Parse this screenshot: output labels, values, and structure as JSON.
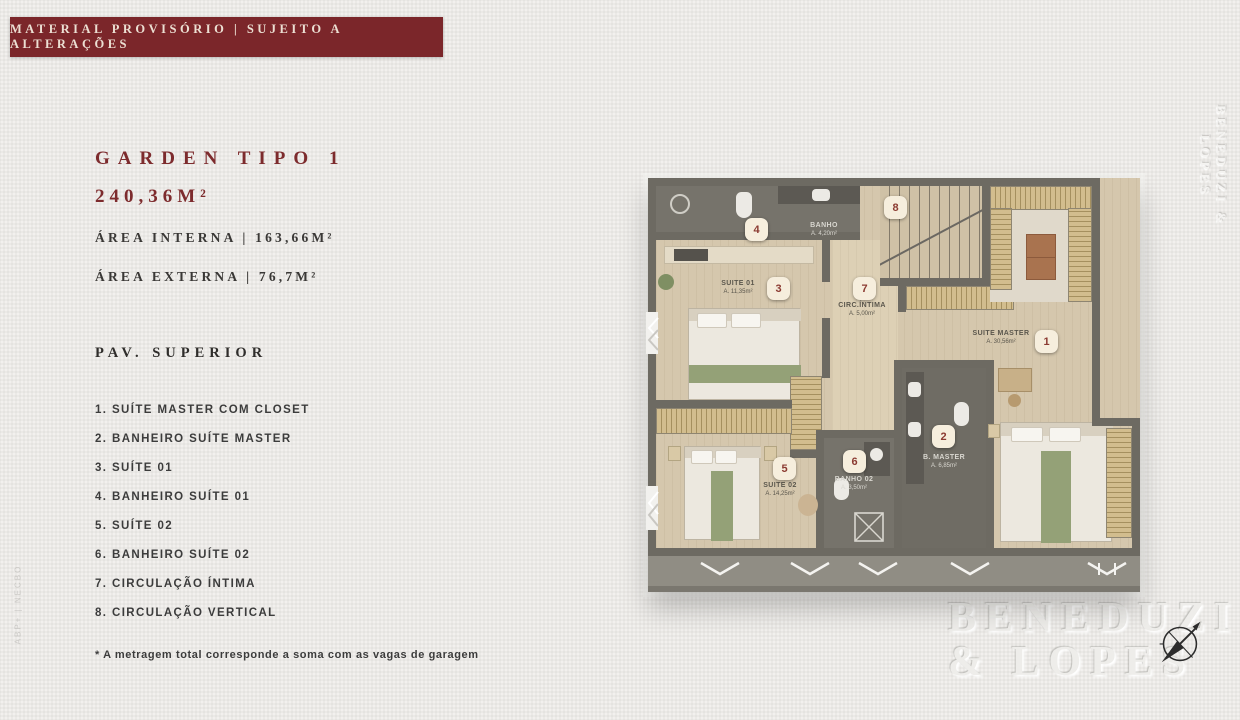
{
  "banner": {
    "text": "MATERIAL PROVISÓRIO | SUJEITO A ALTERAÇÕES"
  },
  "unit": {
    "title": "GARDEN TIPO 1",
    "total_area": "240,36M²",
    "area_interna": "ÁREA INTERNA | 163,66M²",
    "area_externa": "ÁREA EXTERNA | 76,7M²",
    "floor_label": "PAV. SUPERIOR"
  },
  "legend": {
    "items": [
      {
        "text": "1. SUÍTE MASTER COM CLOSET"
      },
      {
        "text": "2. BANHEIRO SUÍTE MASTER"
      },
      {
        "text": "3. SUÍTE 01"
      },
      {
        "text": "4. BANHEIRO SUÍTE 01"
      },
      {
        "text": "5. SUÍTE 02"
      },
      {
        "text": "6. BANHEIRO SUÍTE 02"
      },
      {
        "text": "7. CIRCULAÇÃO ÍNTIMA"
      },
      {
        "text": "8. CIRCULAÇÃO VERTICAL"
      }
    ]
  },
  "footnote": "* A metragem total corresponde a soma com as vagas de garagem",
  "floorplan": {
    "markers": [
      "1",
      "2",
      "3",
      "4",
      "5",
      "6",
      "7",
      "8"
    ],
    "rooms": {
      "banho01": {
        "name": "BANHO",
        "area": "A. 4,20m²"
      },
      "suite01": {
        "name": "SUITE 01",
        "area": "A. 11,35m²"
      },
      "circ": {
        "name": "CIRC.ÍNTIMA",
        "area": "A. 5,00m²"
      },
      "suite_master": {
        "name": "SUITE MASTER",
        "area": "A. 30,56m²"
      },
      "suite02": {
        "name": "SUITE 02",
        "area": "A. 14,25m²"
      },
      "banho02": {
        "name": "BANHO 02",
        "area": "A. 3,50m²"
      },
      "b_master": {
        "name": "B. MASTER",
        "area": "A. 6,85m²"
      }
    }
  },
  "brand": {
    "line1": "BENEDUZI",
    "line2": "& LOPES"
  },
  "watermarks": {
    "right_vertical": "BENEDUZI & LOPES",
    "left_vertical": "ABP+  |  NECBO"
  },
  "colors": {
    "banner_bg": "#7b262a",
    "accent_red": "#7d2b2d",
    "text_dark": "#3c3c3c",
    "marker_bg": "#f6eedd",
    "marker_text": "#8b3a31",
    "wall": "#6d6a62",
    "floor_wood": "#d5c7ad"
  }
}
